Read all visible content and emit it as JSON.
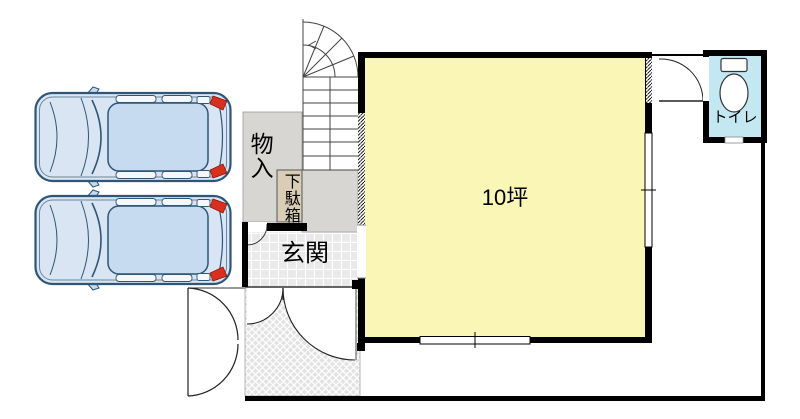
{
  "labels": {
    "storage": "物入",
    "shoe_cabinet": "下駄箱",
    "entrance": "玄関",
    "main_room_area": "10坪",
    "toilet": "トイレ"
  },
  "colors": {
    "main_room_fill": "#FAF6B6",
    "toilet_floor_fill": "#C3E8F2",
    "storage_fill": "#D7D6D3",
    "shoe_cabinet_fill": "#D9CDB5",
    "entrance_tile_fill": "#E9E9E9",
    "porch_hatch_fill": "#E2E2E2",
    "wall_color": "#000000",
    "car_body_fill": "#D9E5F2",
    "car_roof_fill": "#C6DBF0",
    "car_outline": "#2F5577",
    "car_taillight": "#D8301F"
  }
}
